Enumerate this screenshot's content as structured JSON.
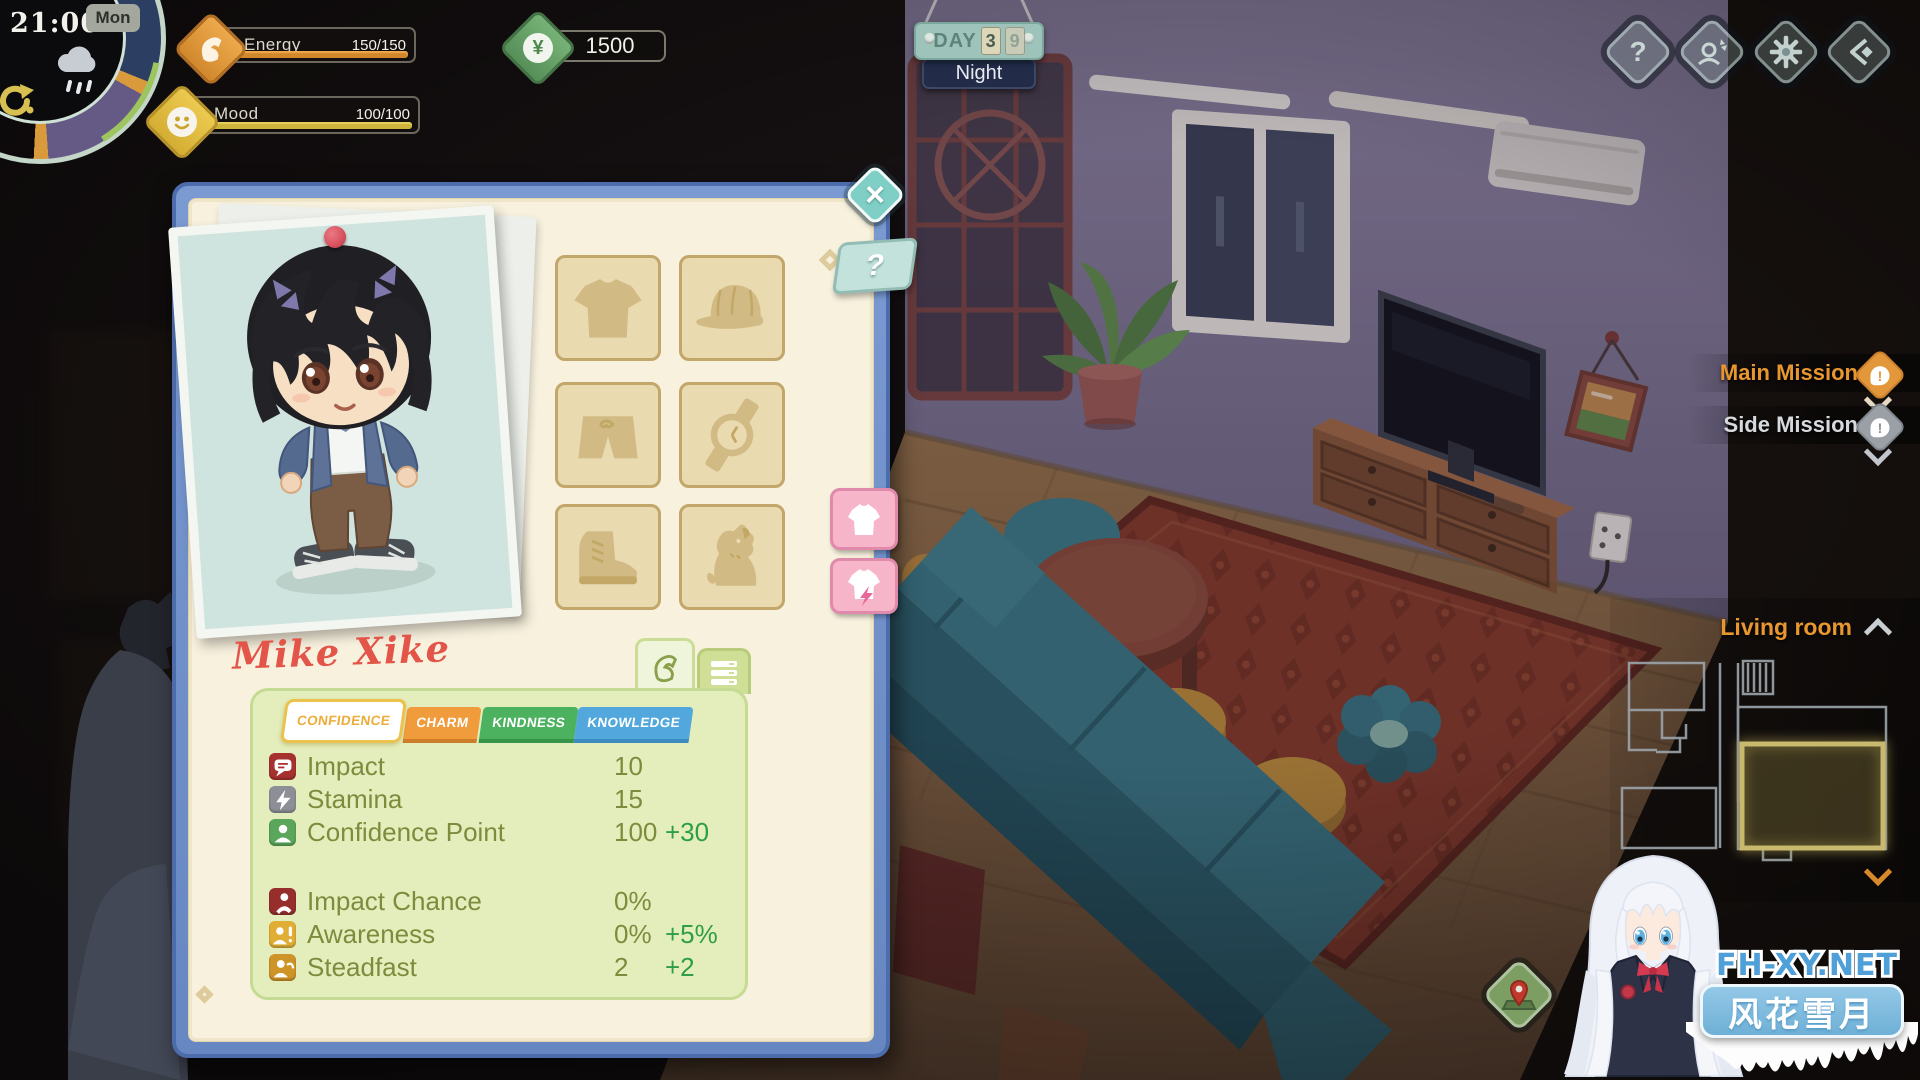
{
  "hud": {
    "time": "21:00",
    "weekday": "Mon",
    "energy_label": "Energy",
    "energy_value": "150/150",
    "mood_label": "Mood",
    "mood_value": "100/100",
    "money": "1500",
    "currency_symbol": "¥"
  },
  "day_board": {
    "label": "DAY",
    "digit1": "3",
    "digit2": "9",
    "phase": "Night"
  },
  "topbar": {
    "help_symbol": "?"
  },
  "panel": {
    "name": "Mike Xike",
    "close_symbol": "×",
    "hint_symbol": "?",
    "tabs": [
      {
        "label": "CONFIDENCE"
      },
      {
        "label": "CHARM"
      },
      {
        "label": "KINDNESS"
      },
      {
        "label": "KNOWLEDGE"
      }
    ],
    "stats": [
      {
        "label": "Impact",
        "value": "10",
        "bonus": ""
      },
      {
        "label": "Stamina",
        "value": "15",
        "bonus": ""
      },
      {
        "label": "Confidence Point",
        "value": "100",
        "bonus": "+30"
      },
      {
        "label": "Impact Chance",
        "value": "0%",
        "bonus": ""
      },
      {
        "label": "Awareness",
        "value": "0%",
        "bonus": "+5%"
      },
      {
        "label": "Steadfast",
        "value": "2",
        "bonus": "+2"
      }
    ]
  },
  "missions": {
    "main_label": "Main Mission",
    "side_label": "Side Mission",
    "alert_symbol": "!"
  },
  "map": {
    "location_label": "Living room"
  },
  "watermark": {
    "site": "FH-XY.NET",
    "brand": "风花雪月"
  },
  "colors": {
    "accent_orange": "#e8962e",
    "energy_fill": "#d1882c",
    "mood_fill": "#cdb23c",
    "money_green": "#5f9e60",
    "bonus_green": "#2f9e44",
    "stat_text": "#7c8c3c",
    "panel_blue": "#7293cc",
    "name_red": "#e25548",
    "tab_charm": "#f09c3c",
    "tab_kindness": "#4cb260",
    "tab_knowledge": "#52a8dc"
  }
}
